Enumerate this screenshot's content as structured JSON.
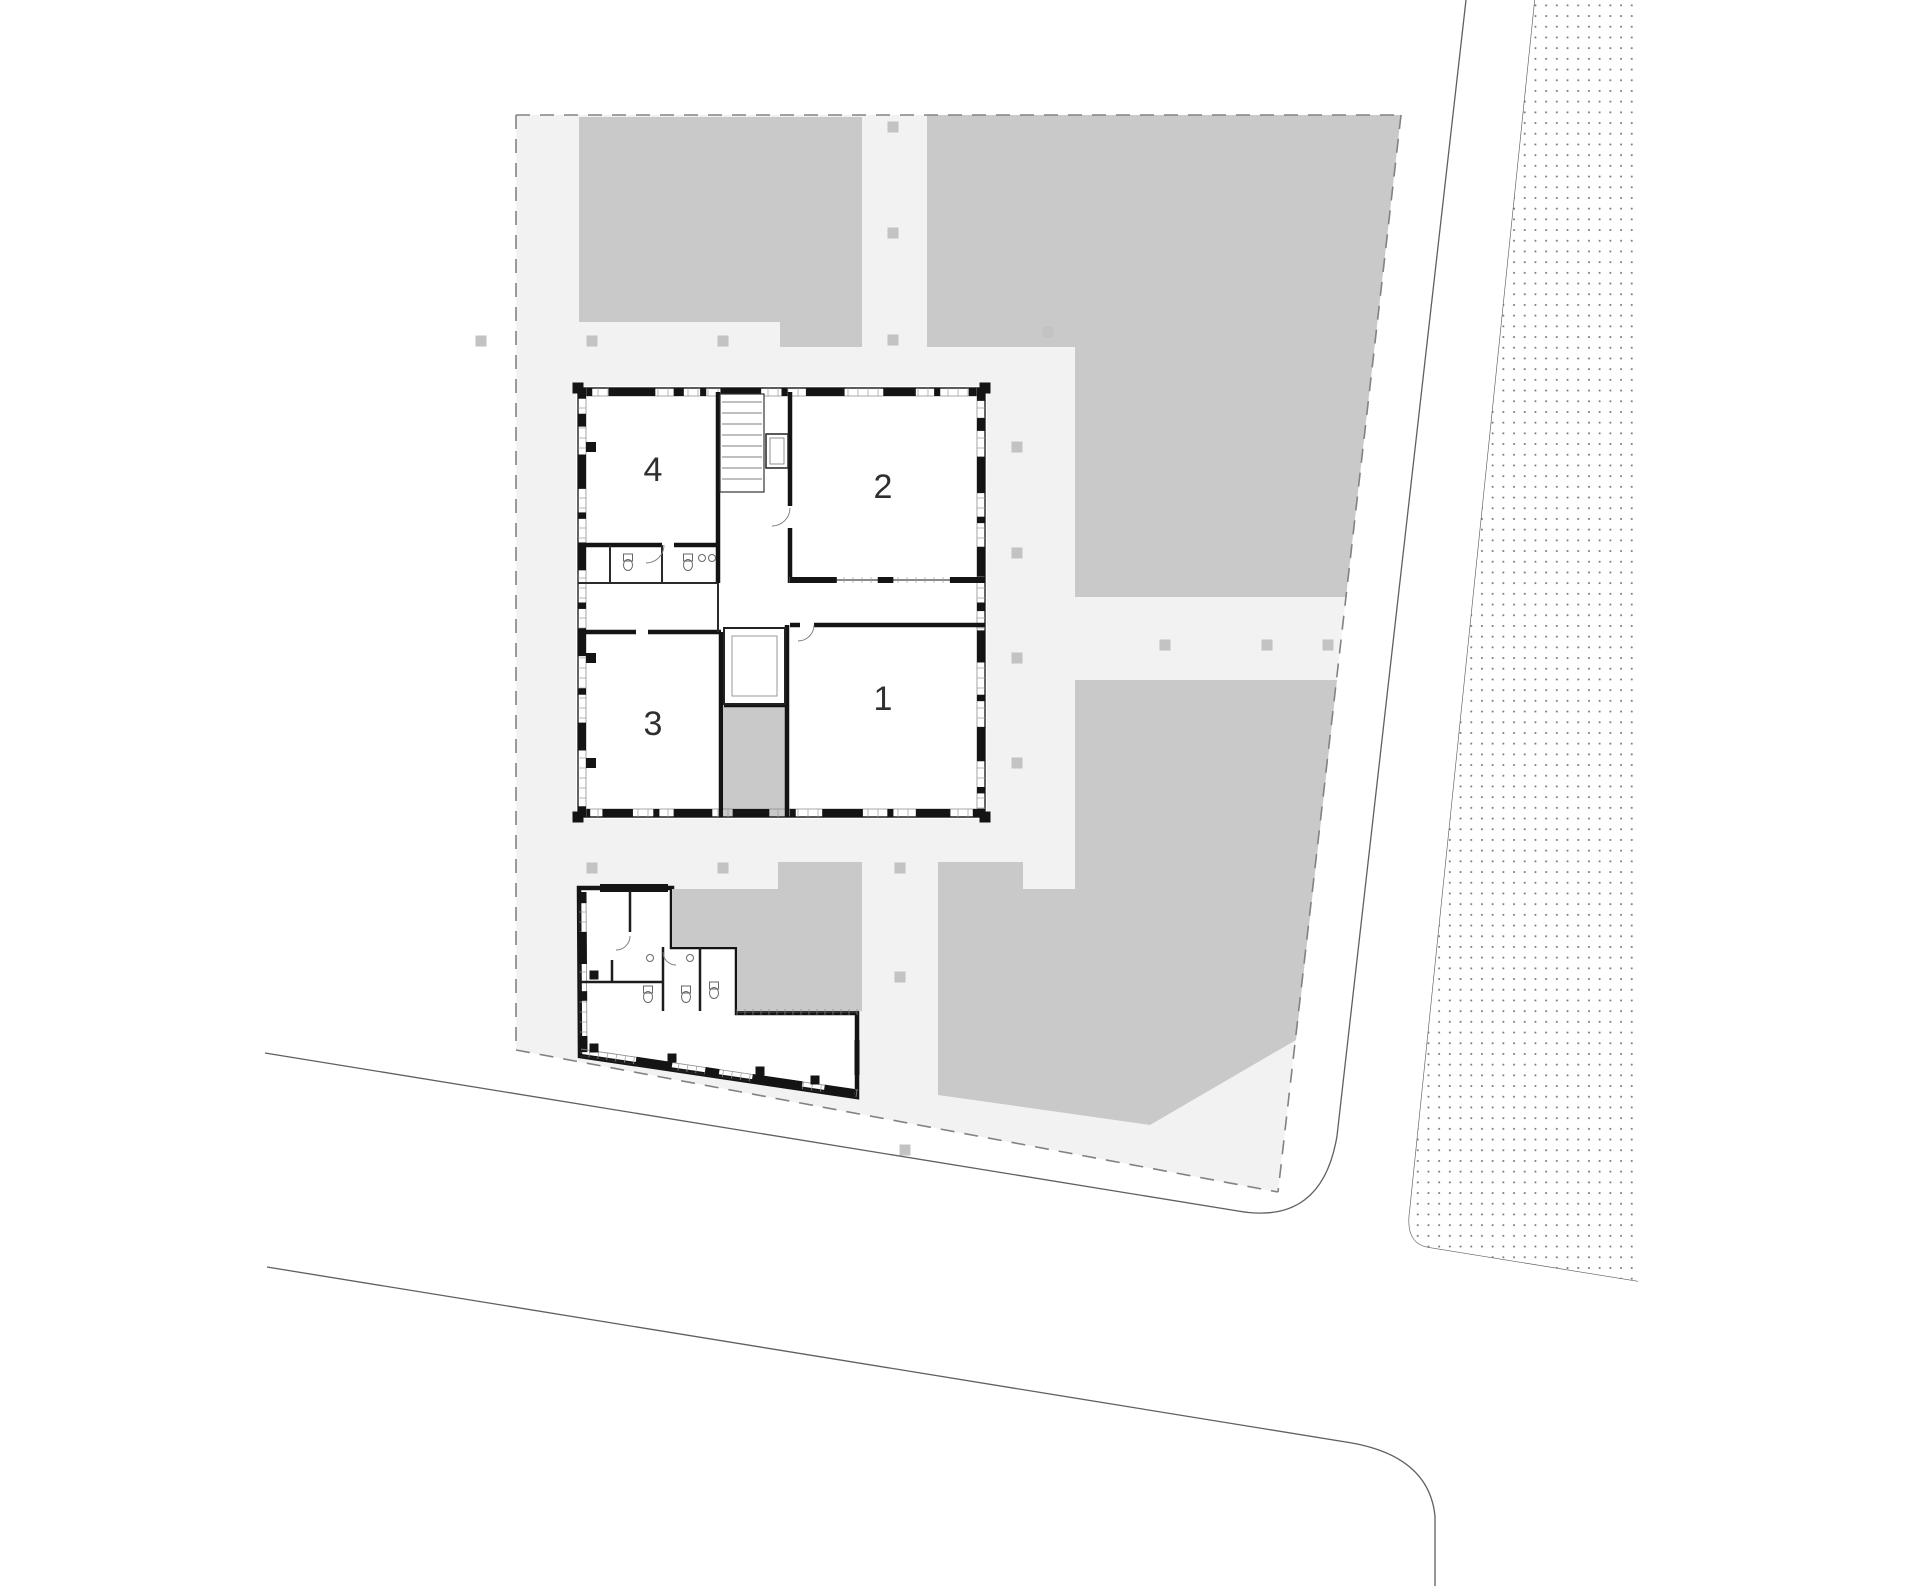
{
  "drawing": {
    "type": "architectural-site-plan",
    "width": 1920,
    "height": 1586
  },
  "rooms": [
    {
      "label": "1",
      "cx": 883,
      "cy": 701
    },
    {
      "label": "2",
      "cx": 883,
      "cy": 489
    },
    {
      "label": "3",
      "cx": 653,
      "cy": 726
    },
    {
      "label": "4",
      "cx": 653,
      "cy": 472
    }
  ],
  "colors": {
    "page_bg": "#ffffff",
    "site_bg": "#f2f2f2",
    "block_gray": "#c9c9c9",
    "tree_gray": "#c3c3c3",
    "wall_black": "#141414",
    "thin_line": "#3a3a3a",
    "road_line": "#5f5f5f",
    "dash_line": "#828282",
    "stipple_dot": "#6e6e6e",
    "inner_line": "#8d8d8d",
    "fixture_line": "#666666"
  },
  "site": {
    "polygon": [
      [
        516,
        115
      ],
      [
        1401,
        115
      ],
      [
        1278,
        1192
      ],
      [
        516,
        1050
      ]
    ],
    "dashed_edges": [
      [
        [
          516,
          115
        ],
        [
          1401,
          115
        ]
      ],
      [
        [
          516,
          115
        ],
        [
          516,
          1050
        ]
      ],
      [
        [
          516,
          1050
        ],
        [
          1278,
          1192
        ]
      ],
      [
        [
          1401,
          115
        ],
        [
          1278,
          1192
        ]
      ]
    ]
  },
  "blocks": [
    {
      "name": "lawn-top-left",
      "points": [
        [
          579,
          117
        ],
        [
          862,
          117
        ],
        [
          862,
          347
        ],
        [
          780,
          347
        ],
        [
          780,
          322
        ],
        [
          579,
          322
        ]
      ]
    },
    {
      "name": "lawn-top-right",
      "points": [
        [
          927,
          115
        ],
        [
          1401,
          115
        ],
        [
          1346,
          597
        ],
        [
          1075,
          597
        ],
        [
          1075,
          347
        ],
        [
          927,
          347
        ]
      ]
    },
    {
      "name": "lawn-bottom-right",
      "points": [
        [
          1075,
          680
        ],
        [
          1337,
          680
        ],
        [
          1296,
          1040
        ],
        [
          1150,
          1125
        ],
        [
          938,
          1095
        ],
        [
          938,
          862
        ],
        [
          1023,
          862
        ],
        [
          1023,
          889
        ],
        [
          1075,
          889
        ]
      ]
    }
  ],
  "courtyards": [
    {
      "name": "court-between-rooms",
      "points": [
        [
          724,
          707
        ],
        [
          786,
          707
        ],
        [
          786,
          817
        ],
        [
          724,
          817
        ]
      ]
    },
    {
      "name": "court-annex",
      "points": [
        [
          672,
          889
        ],
        [
          778,
          889
        ],
        [
          778,
          862
        ],
        [
          862,
          862
        ],
        [
          862,
          1011
        ],
        [
          737,
          1011
        ],
        [
          737,
          947
        ],
        [
          672,
          947
        ]
      ]
    }
  ],
  "trees": [
    [
      481,
      341
    ],
    [
      592,
      341
    ],
    [
      723,
      341
    ],
    [
      893,
      127
    ],
    [
      893,
      233
    ],
    [
      893,
      340
    ],
    [
      1048,
      332
    ],
    [
      1017,
      447
    ],
    [
      1017,
      553
    ],
    [
      1017,
      658
    ],
    [
      1017,
      763
    ],
    [
      592,
      868
    ],
    [
      723,
      868
    ],
    [
      900,
      868
    ],
    [
      900,
      977
    ],
    [
      1165,
      645
    ],
    [
      1267,
      645
    ],
    [
      1328,
      645
    ],
    [
      905,
      1150
    ]
  ],
  "roads": {
    "line_a": "M265,1053 L1238,1211 Q1322,1226 1337,1136 L1466,0",
    "line_b": "M267,1267 L1352,1443 Q1429,1457 1435,1516 L1435,1586",
    "stipple_boundary": "M1535,0 L1410,1210 Q1405,1243 1428,1247 L1638,1281"
  },
  "stipple": {
    "region": "M1535,0 L1638,0 L1638,1281 L1428,1247 Q1405,1243 1410,1210 Z",
    "spacing": 10.7,
    "dot_size": 1.7
  },
  "main_building": {
    "outer": [
      578,
      388,
      407,
      429
    ],
    "corner_pier": 11,
    "facade_inset": 8,
    "tick_spacing": 10,
    "piers": {
      "top": [
        [
          0,
          0.035
        ],
        [
          0.075,
          0.19
        ],
        [
          0.235,
          0.26
        ],
        [
          0.3,
          0.315
        ],
        [
          0.35,
          0.45
        ],
        [
          0.5,
          0.515
        ],
        [
          0.56,
          0.655
        ],
        [
          0.75,
          0.83
        ],
        [
          0.875,
          0.89
        ],
        [
          0.96,
          1
        ]
      ],
      "right": [
        [
          0,
          0.03
        ],
        [
          0.07,
          0.1
        ],
        [
          0.16,
          0.245
        ],
        [
          0.3,
          0.315
        ],
        [
          0.37,
          0.44
        ],
        [
          0.5,
          0.52
        ],
        [
          0.565,
          0.64
        ],
        [
          0.715,
          0.73
        ],
        [
          0.79,
          0.87
        ],
        [
          0.93,
          0.945
        ],
        [
          0.98,
          1
        ]
      ],
      "bottom": [
        [
          0,
          0.03
        ],
        [
          0.06,
          0.135
        ],
        [
          0.185,
          0.2
        ],
        [
          0.235,
          0.33
        ],
        [
          0.38,
          0.47
        ],
        [
          0.52,
          0.535
        ],
        [
          0.6,
          0.7
        ],
        [
          0.76,
          0.775
        ],
        [
          0.83,
          0.915
        ],
        [
          0.97,
          1
        ]
      ],
      "left": [
        [
          0,
          0.025
        ],
        [
          0.06,
          0.09
        ],
        [
          0.155,
          0.235
        ],
        [
          0.29,
          0.305
        ],
        [
          0.36,
          0.425
        ],
        [
          0.5,
          0.515
        ],
        [
          0.56,
          0.625
        ],
        [
          0.7,
          0.715
        ],
        [
          0.78,
          0.845
        ],
        [
          0.975,
          1
        ]
      ]
    },
    "walls_thick": [
      [
        718,
        392,
        718,
        583
      ],
      [
        578,
        545,
        662,
        545
      ],
      [
        674,
        545,
        718,
        545
      ],
      [
        790,
        392,
        790,
        506
      ],
      [
        790,
        528,
        790,
        583
      ],
      [
        814,
        625,
        985,
        625
      ],
      [
        790,
        625,
        800,
        625
      ],
      [
        787,
        625,
        787,
        817
      ],
      [
        721,
        632,
        721,
        817
      ],
      [
        578,
        632,
        636,
        632
      ],
      [
        648,
        632,
        721,
        632
      ],
      [
        724,
        705,
        788,
        705
      ]
    ],
    "walls_thin": [
      [
        610,
        545,
        610,
        583
      ],
      [
        662,
        545,
        662,
        583
      ],
      [
        578,
        583,
        718,
        583
      ],
      [
        718,
        583,
        718,
        632
      ]
    ],
    "glazed_wall": {
      "x1": 790,
      "y1": 580,
      "x2": 985,
      "y2": 580,
      "chunks": [
        [
          0,
          0.24
        ],
        [
          0.45,
          0.53
        ],
        [
          0.82,
          1
        ]
      ]
    },
    "stair": {
      "shaft": [
        720,
        394,
        44,
        98
      ],
      "rung_from": 402,
      "rung_to": 488,
      "rung_step": 11
    },
    "lift": {
      "outer": [
        766,
        434,
        22,
        34
      ],
      "inner": [
        770,
        438,
        14,
        26
      ]
    },
    "patio": {
      "outer": [
        724,
        628,
        61,
        76
      ],
      "inner": [
        732,
        636,
        45,
        60
      ]
    },
    "columns": [
      [
        591,
        447
      ],
      [
        591,
        658
      ],
      [
        591,
        763
      ]
    ],
    "toilets": [
      [
        628,
        562
      ],
      [
        688,
        562
      ]
    ],
    "sinks": [
      [
        702,
        558
      ],
      [
        712,
        558
      ]
    ],
    "door_arcs": [
      "M664,545 A18,18 0 0 1 646,563",
      "M790,508 A18,18 0 0 1 772,526",
      "M814,625 A16,16 0 0 1 798,641"
    ]
  },
  "annex": {
    "outline": "M579,888 L672,888 L672,947 L737,947 L737,1013 L857,1013 L857,1097 L580,1056 Z",
    "top_bar": [
      [
        600,
        888
      ],
      [
        668,
        888
      ]
    ],
    "left_facade": {
      "x1": 579,
      "y1": 892,
      "x2": 580,
      "y2": 1052,
      "piers": [
        [
          0,
          0.07
        ],
        [
          0.25,
          0.45
        ],
        [
          0.62,
          0.68
        ],
        [
          0.9,
          1
        ]
      ]
    },
    "bottom_facade": {
      "x1": 580,
      "y1": 1056,
      "x2": 857,
      "y2": 1097,
      "piers": [
        [
          0.2,
          0.33
        ],
        [
          0.45,
          0.5
        ],
        [
          0.62,
          0.8
        ],
        [
          0.88,
          0.99
        ]
      ]
    },
    "right_pier": [
      857,
      1040,
      857,
      1075
    ],
    "fence_ticks": [
      737,
      1012,
      857,
      1012
    ],
    "walls": [
      [
        630,
        890,
        630,
        932
      ],
      [
        663,
        947,
        663,
        1011
      ],
      [
        700,
        947,
        700,
        1011
      ],
      [
        579,
        982,
        663,
        982
      ],
      [
        612,
        960,
        612,
        982
      ]
    ],
    "wall_squares": [
      [
        672,
        1058
      ],
      [
        760,
        1071
      ],
      [
        815,
        1080
      ],
      [
        594,
        975
      ],
      [
        594,
        1048
      ]
    ],
    "toilets": [
      [
        648,
        994
      ],
      [
        686,
        994
      ],
      [
        714,
        990
      ]
    ],
    "sinks": [
      [
        650,
        958
      ],
      [
        690,
        958
      ]
    ],
    "door_arcs": [
      "M630,936 A14,14 0 0 1 616,950",
      "M663,952 A13,13 0 0 0 676,965"
    ]
  }
}
